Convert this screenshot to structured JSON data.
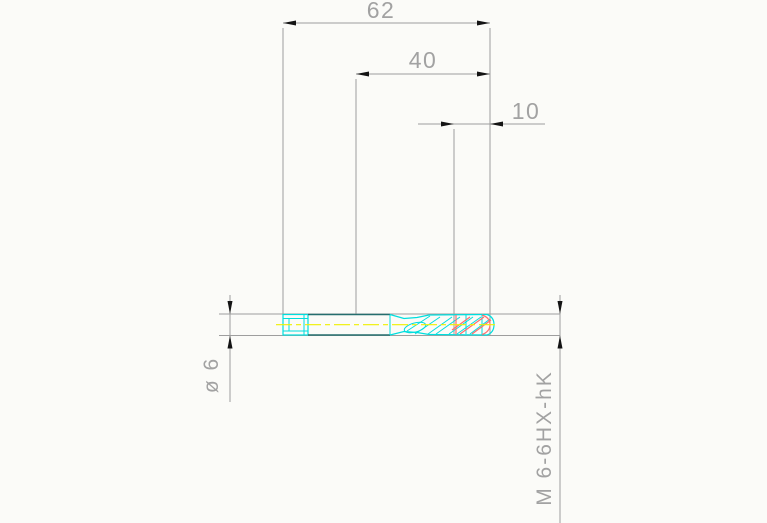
{
  "drawing": {
    "kind": "technical-drawing-machine-tap",
    "dimensions": {
      "overall_length": "62",
      "intermediate_length": "40",
      "thread_length": "10"
    },
    "labels": {
      "shank_diameter": "ø 6",
      "thread_spec": "M 6-6HX-hK"
    }
  },
  "colors": {
    "background": "#fbfbf8",
    "line_gray": "#9e9e9e",
    "text_gray": "#a2a2a2",
    "arrow_black": "#141414",
    "part_outline_cyan": "#00dede",
    "part_edge_teal": "#256e6e",
    "centerline_yellow": "#f0f000",
    "thread_red": "#ff6e6e"
  }
}
